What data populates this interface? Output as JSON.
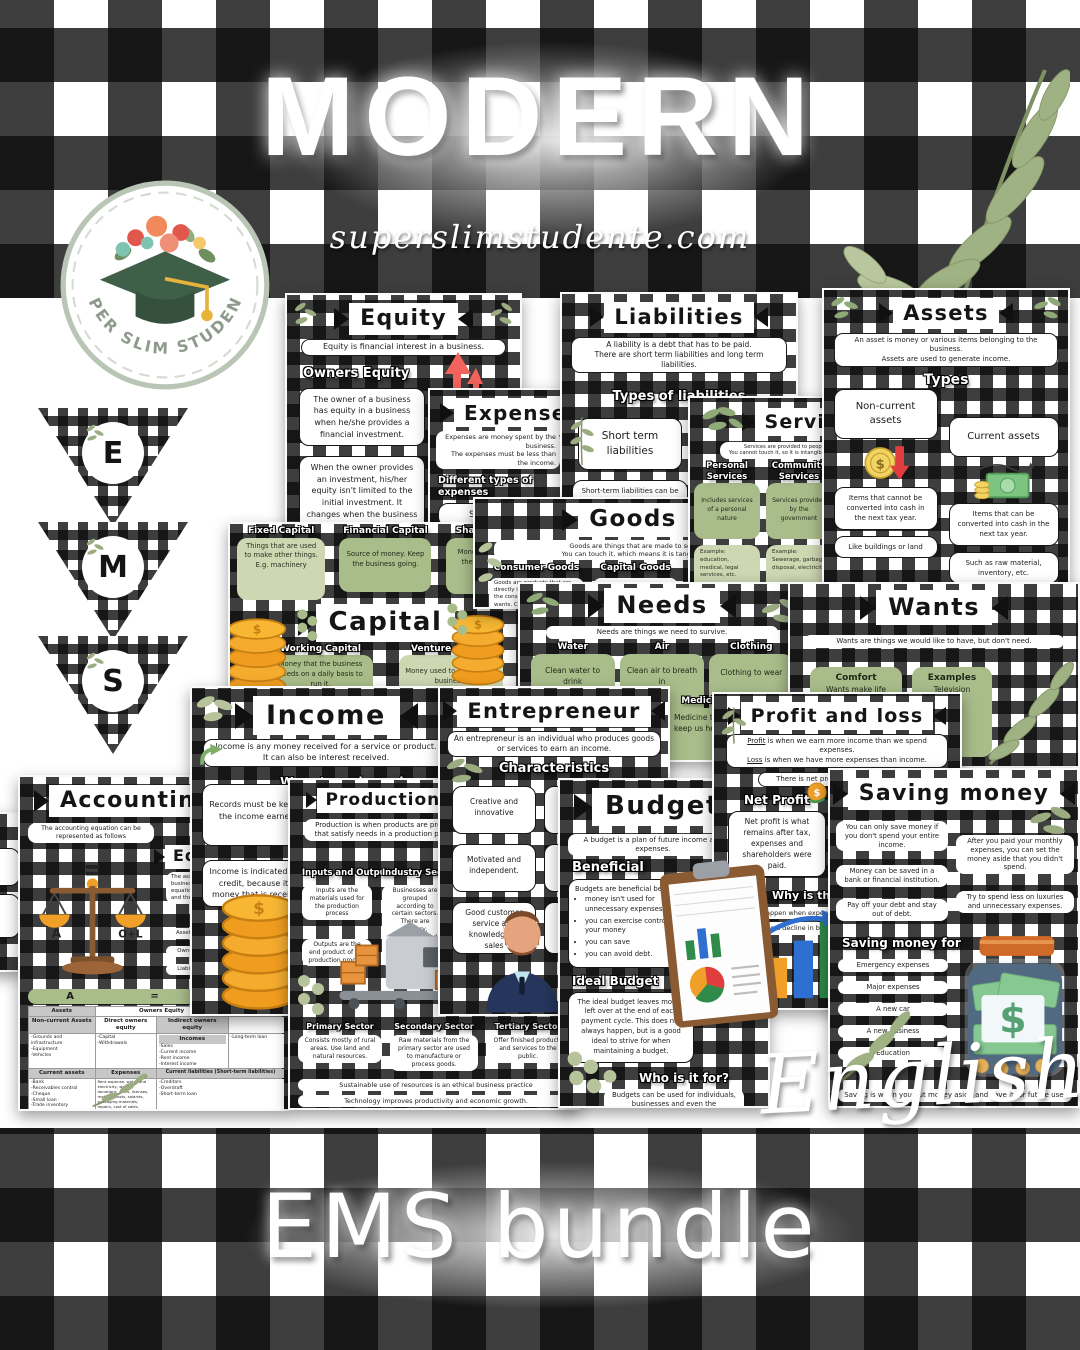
{
  "page": {
    "title": "MODERN",
    "website": "superslimstudente.com",
    "language_label": "English",
    "bundle_title": "EMS bundle"
  },
  "logo": {
    "badge_text": "SUPER SLIM STUDENTE"
  },
  "pennants": {
    "letters": [
      "E",
      "M",
      "S"
    ]
  },
  "icons": [
    "graduation-cap",
    "leaf-sprig",
    "coin-stack",
    "balance-scale",
    "money-jar",
    "clipboard-charts",
    "bar-chart-growth",
    "entrepreneur-avatar",
    "factory-machine",
    "coin-red-arrow",
    "cash-notes",
    "water-glass",
    "plant-sprout",
    "clothing-stack",
    "red-up-arrows",
    "green-curved-arrow",
    "dollar-sign"
  ],
  "colors": {
    "plaid_black": "#141414",
    "sage": "#a9bd8b",
    "sage_light": "#cdd7b2",
    "gold": "#f0a028",
    "red": "#e8564f",
    "navy": "#25355c",
    "white": "#ffffff"
  },
  "posters": {
    "equity": {
      "title": "Equity",
      "subtitle": "Equity is financial interest in a business.",
      "section": "Owners Equity",
      "cards": [
        "The owner of a business has equity in a business when he/she provides a financial investment.",
        "When the owner provides an investment, his/her equity isn't limited to the initial investment. It changes when the business starts earning an income."
      ]
    },
    "liabilities": {
      "title": "Liabilities",
      "subtitle1": "A liability is a debt that has to be paid.",
      "subtitle2": "There are short term liabilities and long term liabilities.",
      "section": "Types of liabilities",
      "card": "Short term liabilities",
      "desc": "Short-term liabilities can be loans that are paid off over a short period of time."
    },
    "assets": {
      "title": "Assets",
      "subtitle1": "An asset is money or various items belonging to the business.",
      "subtitle2": "Assets are used to generate income.",
      "section": "Types",
      "col1": {
        "head": "Non-current assets",
        "desc": "Items that cannot be converted into cash in the next tax year.",
        "example": "Like buildings or land"
      },
      "col2": {
        "head": "Current assets",
        "desc": "Items that can be converted into cash in the next tax year.",
        "example": "Such as raw material, inventory, etc."
      }
    },
    "expenses": {
      "title": "Expenses",
      "subtitle1": "Expenses are money spent by the business.",
      "subtitle2": "The expenses must be less than the income.",
      "section": "Different types of expenses",
      "items": [
        "Salaries",
        "Rent",
        "Water and electricity"
      ]
    },
    "services": {
      "title": "Services",
      "subtitle1": "Services are provided to people.",
      "subtitle2": "You cannot touch it, so it is intangible.",
      "col1": {
        "head": "Personal Services",
        "desc": "Includes services of a personal nature",
        "example": "Example: education, medical, legal services, etc."
      },
      "col2": {
        "head": "Community Services",
        "desc": "Services provided by the government",
        "example": "Example: Sewerage, garbage disposal, electricity"
      }
    },
    "goods": {
      "title": "Goods",
      "subtitle1": "Goods are things that are made to sell.",
      "subtitle2": "You can touch it, which means it is tangible.",
      "col1_head": "Consumer Goods",
      "col1_desc": "Goods are products that are directly involved in satisfying the consumer's needs and wants. Can be durable or non-durable.",
      "col1_example": "Example: TVs, furniture. Coffee, sugar.",
      "col2_head": "Capital Goods",
      "col3_head": "Semi-finished/ Intermediate goods"
    },
    "capital": {
      "title": "Capital",
      "cards_top": [
        {
          "head": "Fixed Capital",
          "desc": "Things that are used to make other things. E.g. machinery"
        },
        {
          "head": "Financial Capital",
          "desc": "Source of money. Keep the business going."
        },
        {
          "head": "Share Capital",
          "desc": "Money invested by the owner of the business."
        }
      ],
      "cards_bottom": [
        {
          "head": "Working Capital",
          "desc": "Money that the business needs on a daily basis to run it."
        },
        {
          "head": "Venture Capital",
          "desc": "Money used to start a new business."
        }
      ]
    },
    "needs": {
      "title": "Needs",
      "subtitle": "Needs are things we need to survive.",
      "cards": [
        {
          "head": "Water",
          "desc": "Clean water to drink"
        },
        {
          "head": "Air",
          "desc": "Clean air to breath in"
        },
        {
          "head": "Clothing",
          "desc": "Clothing to wear"
        },
        {
          "head": "Medicine",
          "desc": "Medicine to keep us healthy"
        }
      ]
    },
    "wants": {
      "title": "Wants",
      "subtitle": "Wants are things we would like to have, but don't need.",
      "cards": [
        {
          "head": "Comfort",
          "desc": "Wants make life more comfortable"
        },
        {
          "head": "Examples",
          "desc": "Television"
        }
      ]
    },
    "income": {
      "title": "Income",
      "subtitle1": "Income is any money received for a service or product.",
      "subtitle2": "It can also be interest received.",
      "section": "Ways to make an income",
      "cards": [
        "Records must be kept of the income earned.",
        "Income is indicated as a credit, because it is money that is received"
      ]
    },
    "entrepreneur": {
      "title": "Entrepreneur",
      "subtitle": "An entrepreneur is an individual who produces goods or services to earn an income.",
      "section": "Characteristics",
      "cards_left": [
        "Creative and innovative",
        "Motivated and independent.",
        "Good customer service and knowledge of sales"
      ],
      "cards_right": [
        "Can work independently",
        "Ready for challenges",
        "Takes risks"
      ]
    },
    "profit_loss": {
      "title": "Profit and loss",
      "profit_word": "Profit",
      "subtitle1_rest": " is when we earn more income than we spend expenses.",
      "loss_word": "Loss",
      "subtitle2_rest": " is when we have more expenses than income.",
      "subtitle3": "There is net profit and gross profit.",
      "section1": "Net Profit",
      "card1": "Net profit is what remains after tax, expenses and shareholders were paid.",
      "section2": "Why is there a loss?",
      "pills": [
        "A loss can happen when expenses are more than income.",
        "There may be a decline in business sales."
      ]
    },
    "accounting": {
      "title": "Accounting",
      "intro": "The accounting equation can be represented as follows",
      "section2": "Equation",
      "card": "The assets, equity and liabilities of a business together form the accounting equation. The 3 parts are combined and the equation must balance.",
      "equations": [
        "Assets = Owners Equity + Liabilities",
        "Owners Equity = Assets - Liabilities",
        "Liabilities = Assets - Owners Equity"
      ],
      "scale_left": "A",
      "scale_right": "O+L",
      "table": {
        "eq_row": [
          "A",
          "=",
          "O"
        ],
        "r1": [
          "Assets",
          "Owners Equity"
        ],
        "r2": [
          "Non-current Assets",
          "Direct owners equity",
          "Indirect owners equity"
        ],
        "incomes_label": "Incomes",
        "lists": {
          "noncurrent": "-Grounds and infrastructure\n-Equipment\n-Vehicles",
          "direct": "-Capital\n-Withdrawals",
          "incomes": "-Sales\n-Current income\n-Rent income\n-Interest income",
          "longterm": "-Long-term loan"
        },
        "r3": [
          "Current assets",
          "Expenses",
          "Current liabilities (Short-term liabilities)"
        ],
        "lists2": {
          "current_assets": "-Bank\n-Receivables control\n-Cheque\n-Small loan\n-Trade inventory",
          "expenses": "Rent expense, water and electricity, wages, donations, rates, licenses, material costs, salaries, packaging materials, repairs, cost of sales, telephone, bank charges, advertising, stationery, fuel, postage, insurance, consumer goods",
          "current_liabilities": "-Creditors\n-Overdraft\n-Short-term loan"
        }
      }
    },
    "production": {
      "title": "Production process",
      "subtitle": "Production is when products are produced that satisfy needs in a production process.",
      "col1_head": "Inputs and Outputs",
      "col1_cards": [
        "Inputs are the materials used for the production process",
        "Outputs are the end product of the production process"
      ],
      "col2_head": "Industry Sectors",
      "col2_card": "Businesses are grouped according to certain sectors. There are primary, secondary and tertiary sectors. All three sectors need each other.",
      "sectors": [
        {
          "head": "Primary Sector",
          "desc": "Consists mostly of rural areas. Use land and natural resources."
        },
        {
          "head": "Secondary Sector",
          "desc": "Raw materials from the primary sector are used to manufacture or process goods."
        },
        {
          "head": "Tertiary Sector",
          "desc": "Offer finished products and services to the public."
        }
      ],
      "footers": [
        "Sustainable use of resources is an ethical business practice",
        "Technology improves productivity and economic growth."
      ]
    },
    "budget": {
      "title": "Budget",
      "subtitle": "A budget is a plan of future income and expenses.",
      "section1": "Beneficial",
      "card1_intro": "Budgets are beneficial because:",
      "bullets": [
        "money isn't used for unnecessary expenses",
        "you can exercise control over your money",
        "you can save",
        "you can avoid debt."
      ],
      "section2": "Ideal Budget",
      "card2": "The ideal budget leaves money left over at the end of each payment cycle. This does not always happen, but is a good ideal to strive for when maintaining a budget.",
      "section3": "Who is it for?",
      "card3": "Budgets can be used for individuals, businesses and even the government."
    },
    "saving": {
      "title": "Saving money",
      "cards_left": [
        "You can only save money if you don't spend your entire income.",
        "Money can be saved in a bank or financial institution.",
        "Pay off your debt and stay out of debt."
      ],
      "cards_right": [
        "After you paid your monthly expenses, you can set the money aside that you didn't spend.",
        "Try to spend less on luxuries and unnecessary expenses."
      ],
      "section": "Saving money for",
      "items": [
        "Emergency expenses",
        "Major expenses",
        "A new car",
        "A new business",
        "Education"
      ],
      "footer": "Saving is when you put money aside and save it for future use."
    }
  }
}
